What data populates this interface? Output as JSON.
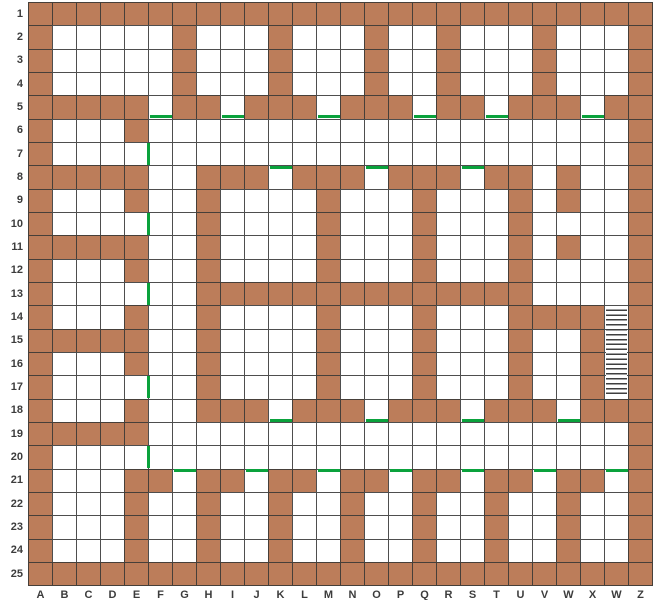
{
  "grid": {
    "rows": 25,
    "cols": 26,
    "row_labels": [
      "1",
      "2",
      "3",
      "4",
      "5",
      "6",
      "7",
      "8",
      "9",
      "10",
      "11",
      "12",
      "13",
      "14",
      "15",
      "16",
      "17",
      "18",
      "19",
      "20",
      "21",
      "22",
      "23",
      "24",
      "25"
    ],
    "col_labels": [
      "A",
      "B",
      "C",
      "D",
      "E",
      "F",
      "G",
      "H",
      "I",
      "J",
      "K",
      "L",
      "M",
      "N",
      "O",
      "P",
      "Q",
      "R",
      "S",
      "T",
      "U",
      "V",
      "W",
      "X",
      "W",
      "Z"
    ],
    "walls": {
      "1": "A-Z",
      "2": "A,G,K,O,R,V,Z",
      "3": "A,G,K,O,R,V,Z",
      "4": "A,G,K,O,R,V,Z",
      "5": "A-E,G-H,J-L,N-P,R-S,U-W,Y-Z",
      "6": "A,E,Z",
      "7": "A,Z",
      "8": "A-E,H-J,L-N,P-R,T-U,W,Z",
      "9": "A,E,H,M,Q,U,W,Z",
      "10": "A,H,M,Q,U,Z",
      "11": "A-E,H,M,Q,U,W,Z",
      "12": "A,E,H,M,Q,U,Z",
      "13": "A,H-U,Z",
      "14": "A,E,H,M,Q,U-X,Z",
      "15": "A-E,H,M,Q,U,X,Z",
      "16": "A,E,H,M,Q,U,X,Z",
      "17": "A,H,M,Q,U,X,Z",
      "18": "A,E,H-J,L-N,P-R,T-V,X-Z",
      "19": "A-E,Z",
      "20": "A,Z",
      "21": "A,E-F,H-I,K-L,N-O,Q-R,T-U,W-X,Z",
      "22": "A,E,H,K,N,Q,T,W,Z",
      "23": "A,E,H,K,N,Q,T,W,Z",
      "24": "A,E,H,K,N,Q,T,W,Z",
      "25": "A-Z"
    },
    "doors": {
      "bottom_edge": [
        "F5",
        "I5",
        "M5",
        "Q5",
        "T5",
        "X5",
        "K18",
        "O18",
        "S18",
        "W18"
      ],
      "top_edge": [
        "K8",
        "O8",
        "S8",
        "G21",
        "J21",
        "M21",
        "P21",
        "S21",
        "V21",
        "Y21"
      ],
      "right_edge": [
        "E7",
        "E10",
        "E13",
        "E17",
        "E20"
      ]
    },
    "hatched_area": {
      "col": "Y",
      "row_start": 14,
      "row_end": 17
    },
    "colors": {
      "wall": "#bc7d5a",
      "door": "#0aa23c",
      "grid_line": "#4e4e4e",
      "background": "#ffffff",
      "label": "#3c3c3c",
      "hatch_line": "#3f3f3f"
    }
  }
}
